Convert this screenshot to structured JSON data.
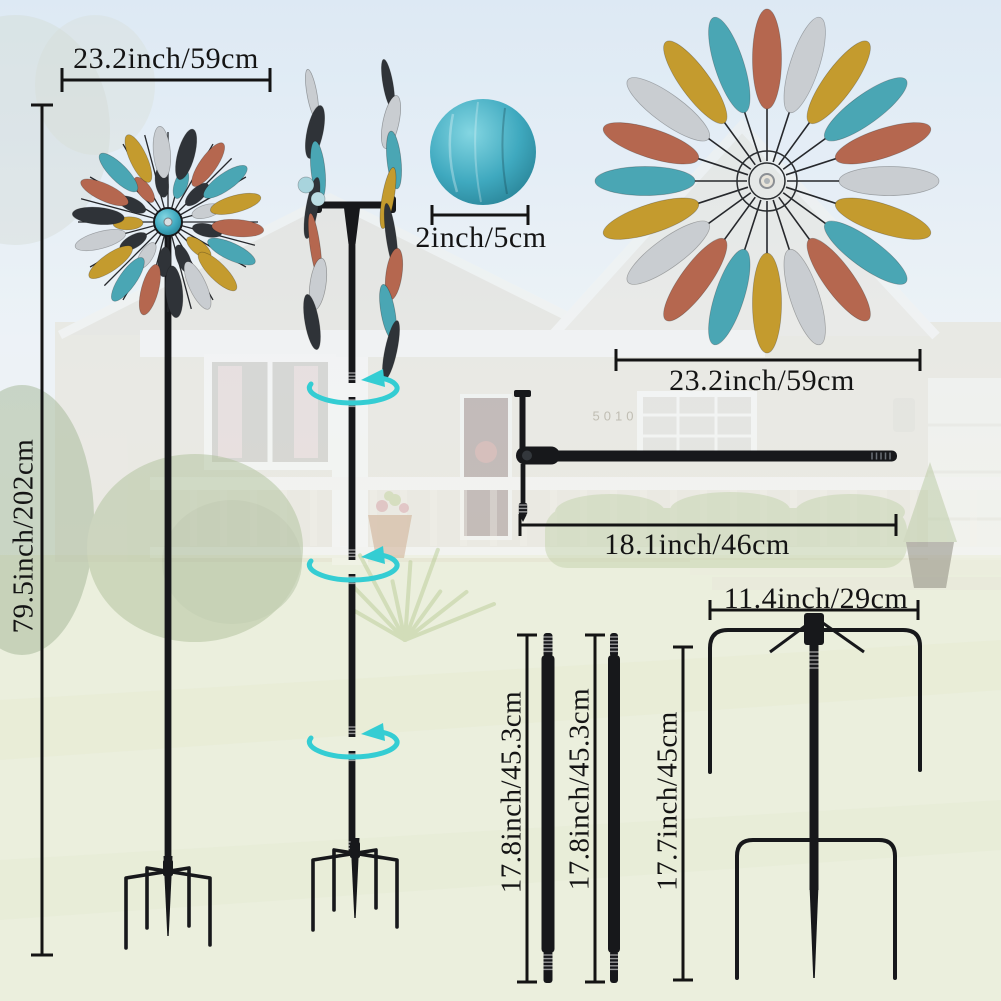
{
  "product_diagram": {
    "dimensions": {
      "spinner_width": "23.2inch/59cm",
      "total_height": "79.5inch/202cm",
      "ball_diameter": "2inch/5cm",
      "wheel_width": "23.2inch/59cm",
      "crossbar_length": "18.1inch/46cm",
      "stake_width": "11.4inch/29cm",
      "pole_1_length": "17.8inch/45.3cm",
      "pole_2_length": "17.8inch/45.3cm",
      "stake_height": "17.7inch/45cm"
    },
    "background_house_number": "5010"
  },
  "colors": {
    "dimension_line": "#141414",
    "metal": "#17181b",
    "rotation_arrow": "#34cdd3",
    "ball_teal": "#3fafc4",
    "blade_copper": "#b5674f",
    "blade_teal": "#4aa6b4",
    "blade_gold": "#c49b2e",
    "blade_silver": "#c9cdd1",
    "blade_black": "#2f3338"
  },
  "blade_sequences": {
    "wheel": [
      "copper",
      "silver",
      "gold",
      "teal"
    ],
    "flower_outer": [
      "copper",
      "teal",
      "gold",
      "silver",
      "black"
    ],
    "flower_inner": [
      "black",
      "silver",
      "black",
      "gold",
      "black",
      "copper",
      "black",
      "teal"
    ],
    "cluster_left": [
      "silver",
      "black",
      "teal",
      "black",
      "copper",
      "silver",
      "black"
    ],
    "cluster_right": [
      "black",
      "silver",
      "teal",
      "gold",
      "black",
      "copper",
      "teal",
      "black"
    ]
  }
}
